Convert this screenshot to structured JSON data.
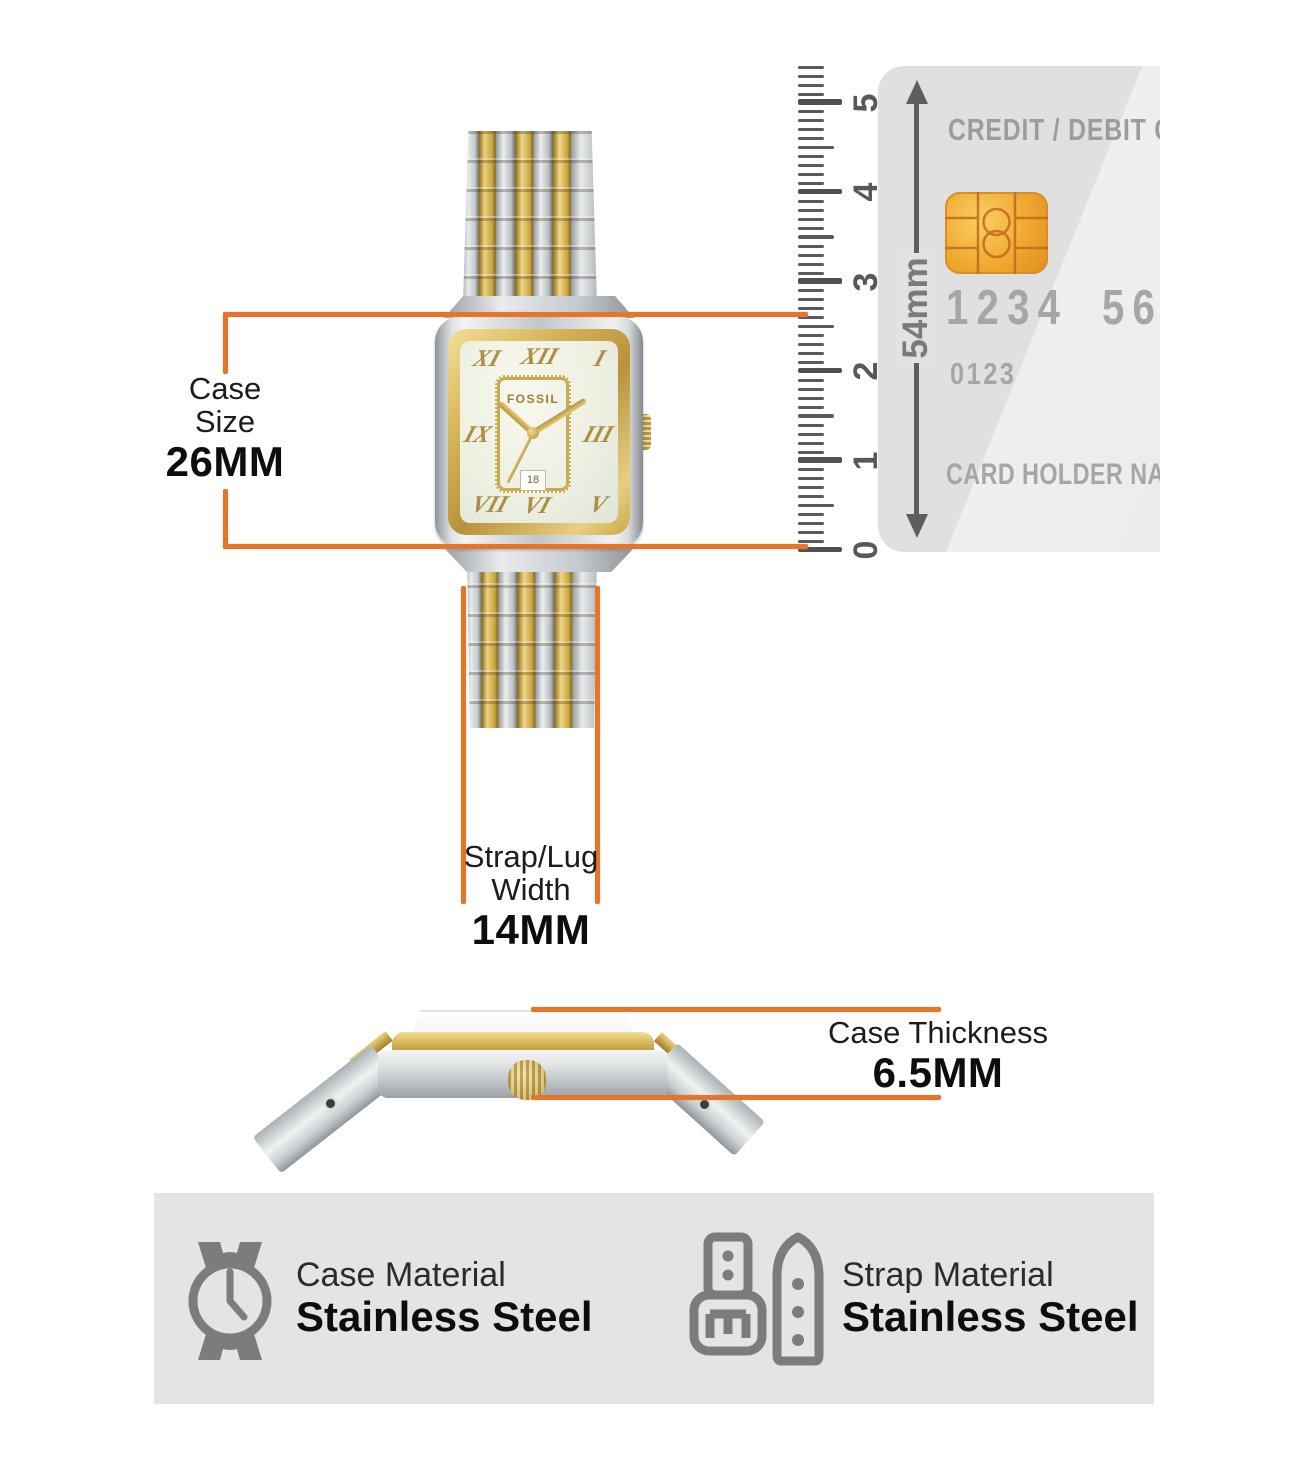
{
  "colors": {
    "accent_orange": "#e4752b",
    "ruler_gray": "#5a5a5a",
    "card_bg": "#e2e2e2",
    "card_text": "#a6a6a6",
    "panel_bg": "#e4e4e4",
    "icon_gray": "#7c7c7c",
    "gold": "#c7a33e",
    "silver": "#c6cbce"
  },
  "measurements": {
    "case_size": {
      "label_line1": "Case",
      "label_line2": "Size",
      "value": "26MM"
    },
    "strap_width": {
      "label_line1": "Strap/Lug",
      "label_line2": "Width",
      "value": "14MM"
    },
    "case_thickness": {
      "label": "Case Thickness",
      "value": "6.5MM"
    }
  },
  "ruler": {
    "unit_labels": [
      "0",
      "1",
      "2",
      "3",
      "4",
      "5"
    ],
    "arrow_label": "54mm"
  },
  "credit_card": {
    "title": "CREDIT / DEBIT C",
    "number_group1": "1234",
    "number_group2": "56",
    "expiry": "0123",
    "holder": "CARD HOLDER NAME"
  },
  "watch": {
    "brand": "FOSSIL",
    "date": "18",
    "dial_numerals": [
      "XI",
      "XII",
      "I",
      "IX",
      "III",
      "VII",
      "VI",
      "V"
    ]
  },
  "materials": {
    "case": {
      "label": "Case Material",
      "value": "Stainless Steel"
    },
    "strap": {
      "label": "Strap Material",
      "value": "Stainless Steel"
    }
  }
}
